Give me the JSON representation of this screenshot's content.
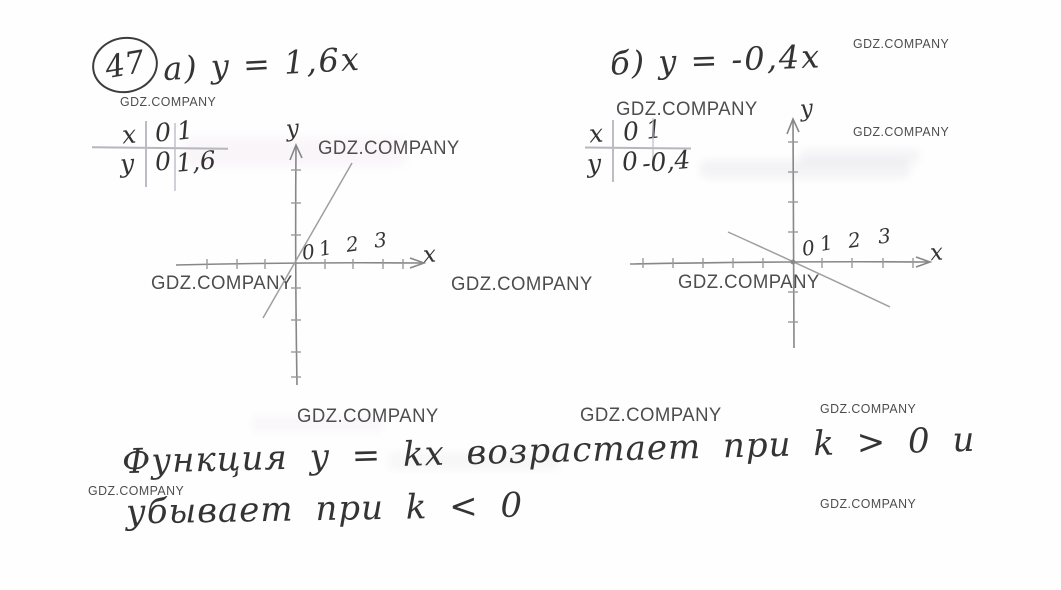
{
  "watermark": "GDZ.COMPANY",
  "problem": {
    "number": "47"
  },
  "part_a": {
    "title": "а) y = 1,6x",
    "table": {
      "rows": [
        [
          "x",
          "0",
          "1"
        ],
        [
          "y",
          "0",
          "1,6"
        ]
      ]
    },
    "graph": {
      "y_axis_label": "y",
      "x_axis_label": "x",
      "x_tick_labels": [
        "0",
        "1",
        "2",
        "3"
      ]
    }
  },
  "part_b": {
    "title": "б) y = -0,4x",
    "table": {
      "rows": [
        [
          "x",
          "0",
          "1"
        ],
        [
          "y",
          "0",
          "-0,4"
        ]
      ]
    },
    "graph": {
      "y_axis_label": "y",
      "x_axis_label": "x",
      "x_tick_labels": [
        "0",
        "1",
        "2",
        "3"
      ]
    }
  },
  "conclusion": {
    "line1": "Функция  y = kx  возрастает  при  k > 0  и",
    "line2": "убывает  при  k < 0"
  },
  "chart_data": [
    {
      "type": "line",
      "title": "а) y = 1,6x",
      "equation": "y = 1,6x",
      "slope": 1.6,
      "points": [
        {
          "x": 0,
          "y": 0
        },
        {
          "x": 1,
          "y": 1.6
        }
      ],
      "x_tick_labels": [
        0,
        1,
        2,
        3
      ],
      "xlabel": "x",
      "ylabel": "y",
      "line_extent_x": [
        -1.1,
        2.0
      ],
      "grid": false,
      "legend": "none"
    },
    {
      "type": "line",
      "title": "б) y = -0,4x",
      "equation": "y = -0,4x",
      "slope": -0.4,
      "points": [
        {
          "x": 0,
          "y": 0
        },
        {
          "x": 1,
          "y": -0.4
        }
      ],
      "x_tick_labels": [
        0,
        1,
        2,
        3
      ],
      "xlabel": "x",
      "ylabel": "y",
      "line_extent_x": [
        -2.2,
        3.3
      ],
      "grid": false,
      "legend": "none"
    }
  ]
}
